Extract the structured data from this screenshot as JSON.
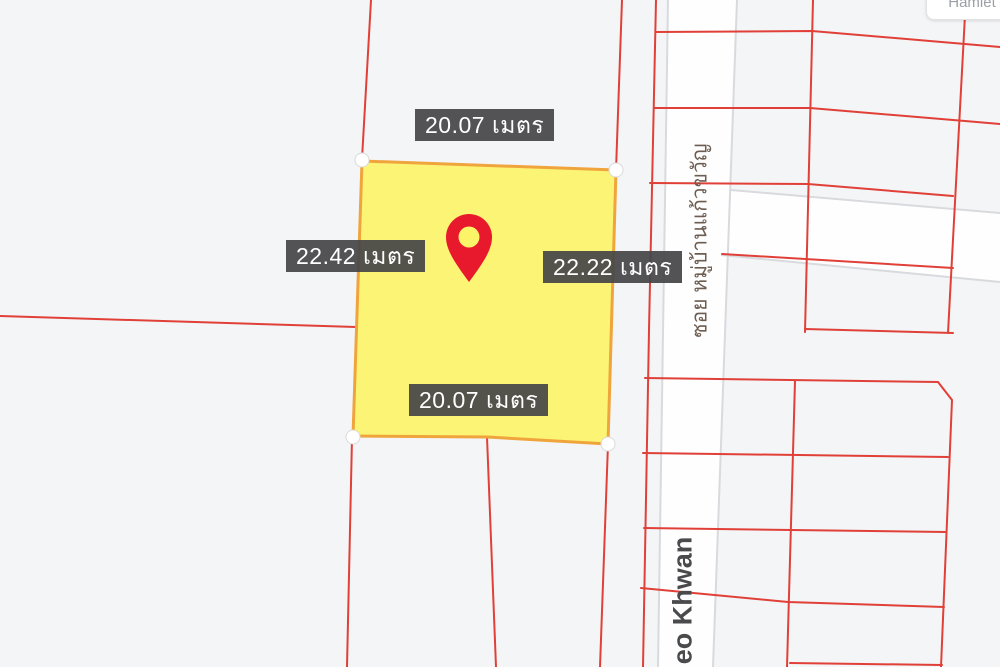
{
  "map": {
    "type": "cadastral-parcel-map",
    "background_color": "#f4f5f7",
    "boundary_line_color": "#e04038",
    "road_fill": "#fefefe",
    "road_edge_color": "#d8dade"
  },
  "parcel": {
    "fill_color": "#fbf368",
    "border_color": "#f0a43c",
    "pin_color": "#e8192c",
    "dimensions": {
      "top": "20.07 เมตร",
      "left": "22.42 เมตร",
      "right": "22.22 เมตร",
      "bottom": "20.07 เมตร"
    }
  },
  "labels": {
    "road_soi": "ซอย หมู่บ้านแก้วขวัญ",
    "road_khwan": "eo Khwan",
    "tooltip_partial": "Hamlet"
  }
}
